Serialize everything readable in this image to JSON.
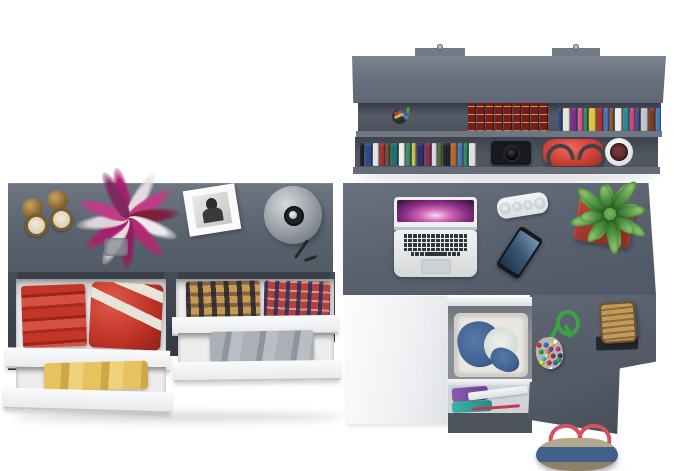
{
  "meta": {
    "description": "Top-down 3D render of a dark gray home office set on a white floor: a wall bookshelf filled with books, a pencil cup, a camera, a red handbag and a potpourri bowl; a long double dresser topped with brass candle holders, a magenta flower bouquet, a white photo frame and a gray dome lamp, its open drawers showing red towels, a red-and-white garment, yellow clothes, plaid shirts and gray folded clothes; and an L-shaped desk with an open laptop, a white pill speaker, a smartphone, a succulent in a red pot, a bead pouch with green cord, a wicker basket on a dark mat, an under-desk drawer with a laundry basket of denim, a shelf with purple and teal clothes, and a denim tote bag with red handles on the floor.",
    "background": "#ffffff",
    "furniture_gray": "#5d6571"
  },
  "bookshelf": {
    "label": "wall bookshelf",
    "slab_color": "#6a7280",
    "shelf_shadow": "#4a505a",
    "encyclopedia": {
      "count": 9,
      "spine": "#771c1c",
      "bands": "#cd9b3c"
    },
    "upper_books": [
      "#30498c",
      "#e7e3dc",
      "#7c2d8c",
      "#d8568f",
      "#2f8a5e",
      "#e2c340",
      "#b03030",
      "#4a6fb5",
      "#8b5a2b",
      "#ececec",
      "#2e8b8b",
      "#c8487f",
      "#474a90",
      "#c4c4c4",
      "#7f3b20",
      "#3f7ab5"
    ],
    "lower_books": [
      "#1f2024",
      "#2e4a8f",
      "#e6e4de",
      "#a82d2d",
      "#6b4a2b",
      "#1f6f6f",
      "#ededed",
      "#3a8a5f",
      "#c8c84a",
      "#2e2e6f",
      "#8b2e4a",
      "#d8d8d8",
      "#4a6b2e",
      "#23242a",
      "#b5652e",
      "#3f7ab5",
      "#2e8b5f",
      "#e0e0e0"
    ],
    "pen_colors": [
      "#c23a35",
      "#3a7fc2",
      "#3aa34a",
      "#e0b23a",
      "#6a4a9a"
    ],
    "camera_color": "#17191c",
    "handbag_color": "#d8453c",
    "handbag_handle": "#3f444c",
    "bowl_color": "#ffffff",
    "bowl_fill": "#5f2c2e"
  },
  "dresser": {
    "label": "double dresser with open drawers",
    "top_color": "#5d6571",
    "interior_color": "#3a3f49",
    "drawer_front_color": "#f7f7f8",
    "candle_brass": "#8a6a33",
    "candle_wax": "#e9e0cb",
    "flower_sprays": [
      "#a81f6e",
      "#e4dade",
      "#c03a85",
      "#7e1f3e",
      "#efe9ec",
      "#b02a72",
      "#8f1f5e",
      "#e8dde4",
      "#a81f6e",
      "#ddd2d8",
      "#c03a85",
      "#7e2a5e"
    ],
    "vase_color": "#8c929b",
    "frame_color": "#fbfbfc",
    "lamp_color": "#9aa0a4",
    "red_towels": "#c23527",
    "striped_garment_red": "#c33429",
    "striped_garment_white": "#e9e4da",
    "yellow_clothes": "#e0bb55",
    "plaid_tan": "#c89a54",
    "plaid_red": "#b2423c",
    "gray_clothes": "#9aa0a8"
  },
  "desk": {
    "label": "L-shaped desk",
    "top_color": "#5d6571",
    "side_panel_color": "#4d545e",
    "under_panel_color": "#f2f3f5",
    "speaker_color": "#eff1f2",
    "phone_body": "#14181d",
    "phone_screen": "#3c5a78",
    "pot_color": "#a83830",
    "cord_color": "#3aa342",
    "pouch_color": "#b8b4ae",
    "mat_color": "#23272e",
    "wicker_color": "#b08448",
    "basket_color": "#e9e7e2",
    "denim_color": "#3f6290",
    "purple_cloth": "#7a4fa0",
    "teal_cloth": "#2fa89a",
    "tote_denim": "#41608a",
    "tote_tan": "#b3a78c",
    "tote_handles": "#d84f63"
  },
  "laptop": {
    "label": "open laptop",
    "body_color": "#e9ebed",
    "key_color": "#2f343a",
    "key_rows": 4,
    "keys_per_row": 14,
    "screen_colors": [
      "#2a1232",
      "#8a2f86",
      "#d465b5",
      "#f0d8ee"
    ]
  },
  "plant": {
    "label": "succulent plant",
    "leaf_count": 16,
    "leaf_light": "#7ab45b",
    "leaf_dark": "#39762e"
  },
  "beads": [
    "#d23a3a",
    "#3a6fd2",
    "#e8d23a",
    "#ffffff",
    "#3aa34a",
    "#d28a3a",
    "#8a3ad2",
    "#d23a8a",
    "#3ad2c8",
    "#d2d2d2",
    "#b03030",
    "#3a3a8a",
    "#e8e83a",
    "#d23a3a",
    "#3a6fd2",
    "#3aa34a",
    "#e8d23a",
    "#ffffff"
  ]
}
